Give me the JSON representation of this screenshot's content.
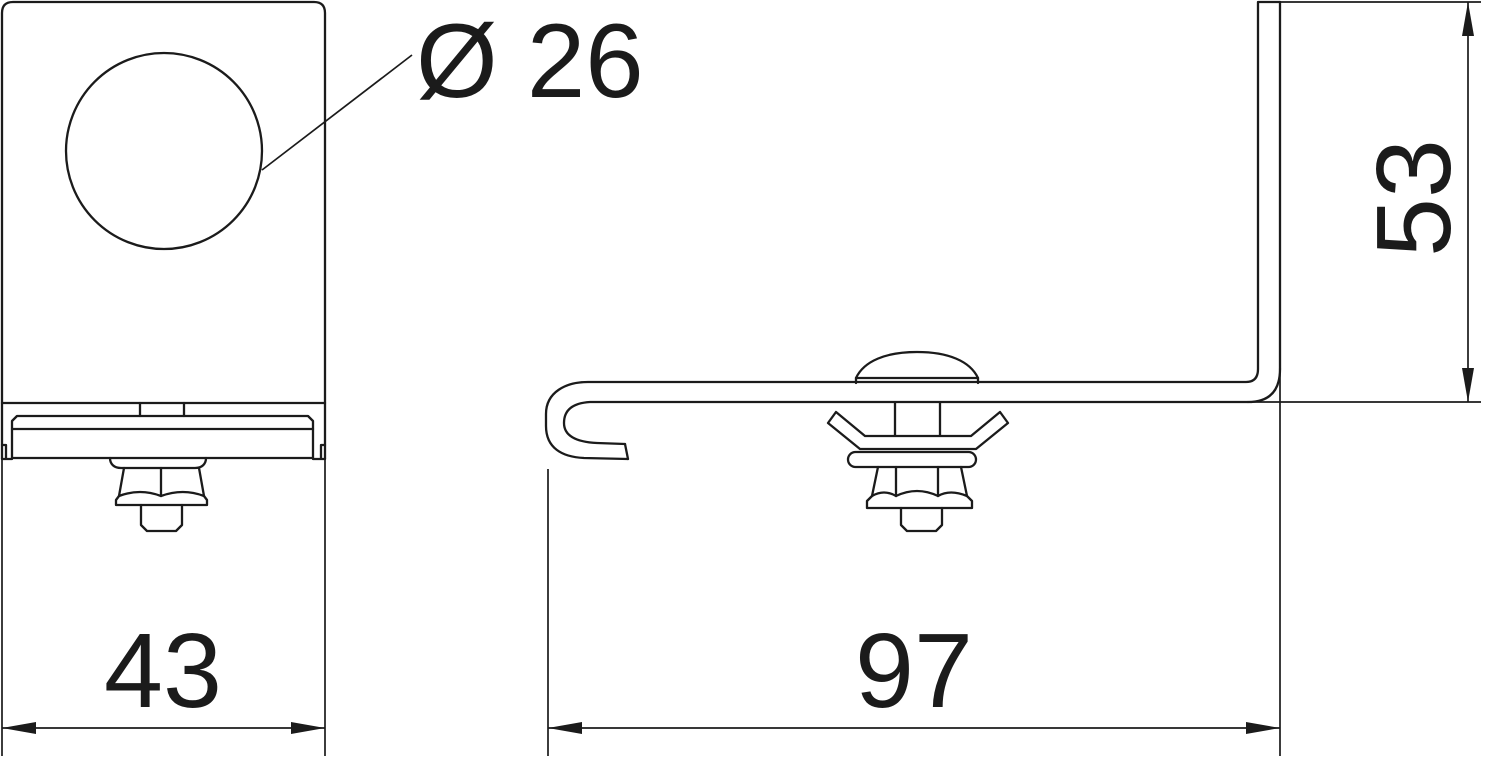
{
  "drawing": {
    "type": "technical-dimension-drawing",
    "background_color": "#ffffff",
    "line_color": "#1b1b1b",
    "labels": {
      "hole_diameter": "Ø 26",
      "front_width": "43",
      "side_length": "97",
      "side_height": "53"
    }
  }
}
